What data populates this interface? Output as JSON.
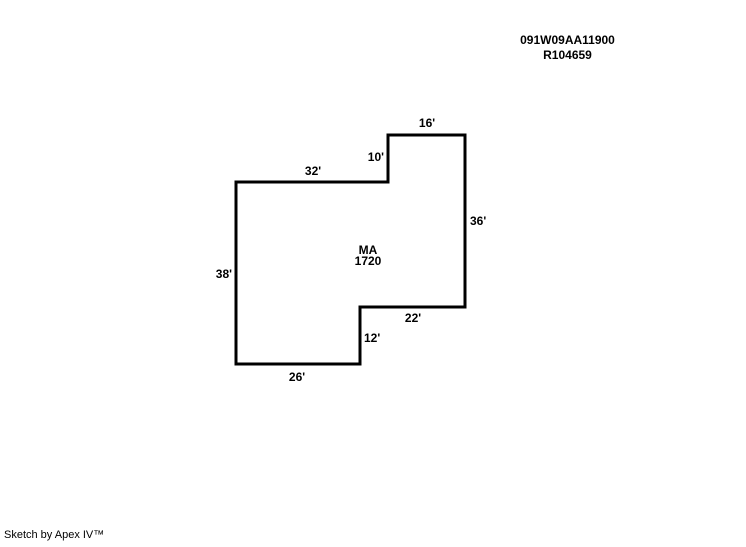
{
  "header": {
    "parcel_id": "091W09AA11900",
    "account_number": "R104659"
  },
  "sketch": {
    "area": {
      "code": "MA",
      "size": "1720"
    },
    "outline_points": "236,182 388,182 388,135 465,135 465,307 360,307 360,364 236,364",
    "dimensions": {
      "top_edge": "16'",
      "notch_edge": "10'",
      "upper_edge": "32'",
      "right_edge": "36'",
      "left_edge": "38'",
      "step_edge": "22'",
      "step_down_edge": "12'",
      "bottom_edge": "26'"
    }
  },
  "footer": {
    "credit": "Sketch by Apex IV™"
  },
  "colors": {
    "line": "#000000",
    "text": "#000000",
    "background": "#ffffff"
  }
}
